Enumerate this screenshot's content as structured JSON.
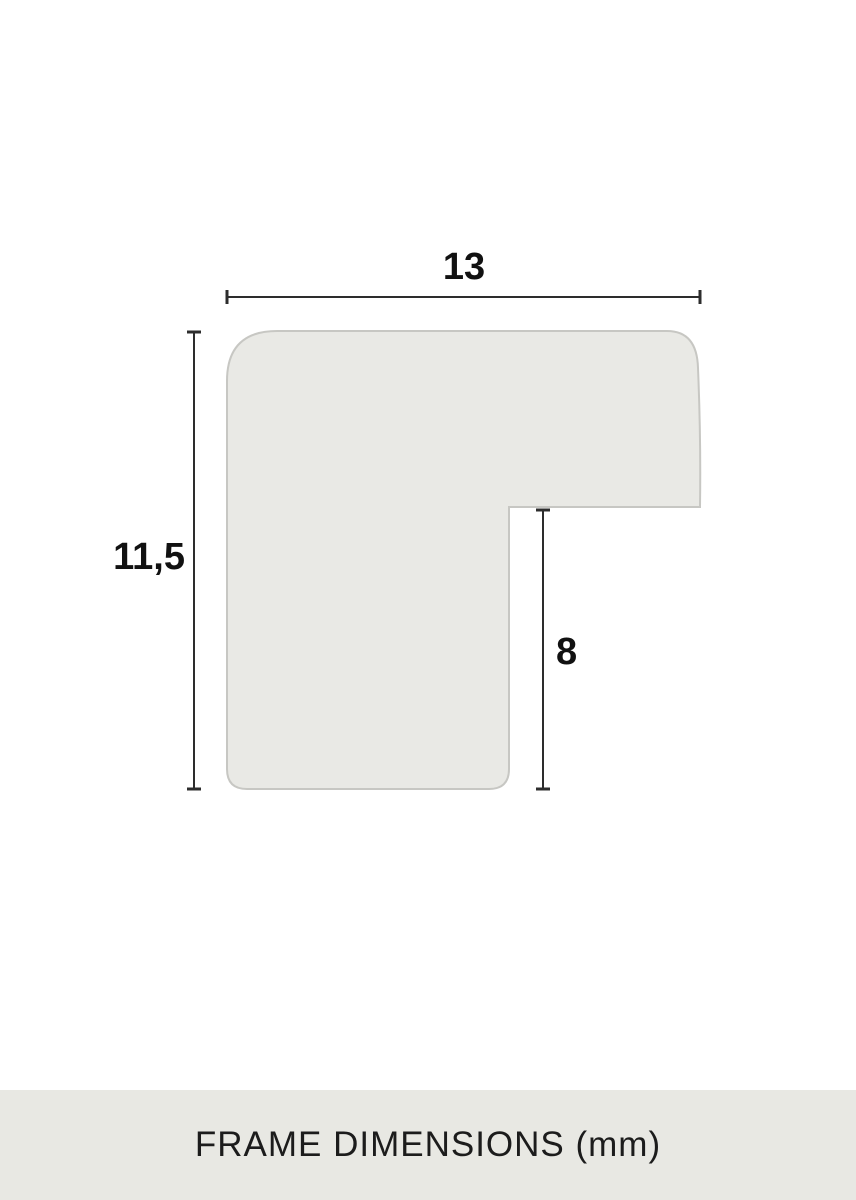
{
  "page": {
    "background": "#ffffff"
  },
  "diagram": {
    "width_label": "13",
    "height_label": "11,5",
    "rabbet_label": "8",
    "shape_fill": "#e9e9e5",
    "shape_stroke": "#c7c7c3",
    "dimension_line_color": "#2d2d2d",
    "label_color": "#111111"
  },
  "footer": {
    "caption": "FRAME DIMENSIONS (mm)",
    "background": "#e8e8e3",
    "text_color": "#1c1c1c"
  }
}
